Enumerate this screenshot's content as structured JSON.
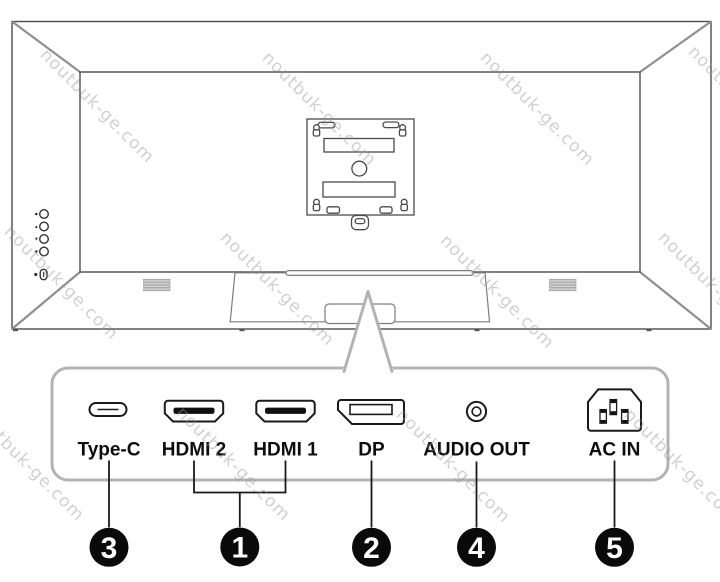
{
  "watermark": {
    "text": "noutbuk-ge.com"
  },
  "ports": {
    "type_c": {
      "label": "Type-C",
      "callout": "3"
    },
    "hdmi_2": {
      "label": "HDMI 2",
      "callout": "1"
    },
    "hdmi_1": {
      "label": "HDMI 1",
      "callout": "1"
    },
    "dp": {
      "label": "DP",
      "callout": "2"
    },
    "audio_out": {
      "label": "AUDIO OUT",
      "callout": "4"
    },
    "ac_in": {
      "label": "AC IN",
      "callout": "5"
    }
  },
  "callout_numbers": {
    "n1": "1",
    "n2": "2",
    "n3": "3",
    "n4": "4",
    "n5": "5"
  },
  "colors": {
    "outline": "#4d4d4d",
    "perspective_line": "#8f8f8f",
    "panel_border": "#b3b3b3",
    "port_line": "#1a1a1a",
    "label_text": "#0d0d0d",
    "callout_fill": "#0a0a0a",
    "callout_text": "#ffffff",
    "watermark_text": "#969696"
  }
}
